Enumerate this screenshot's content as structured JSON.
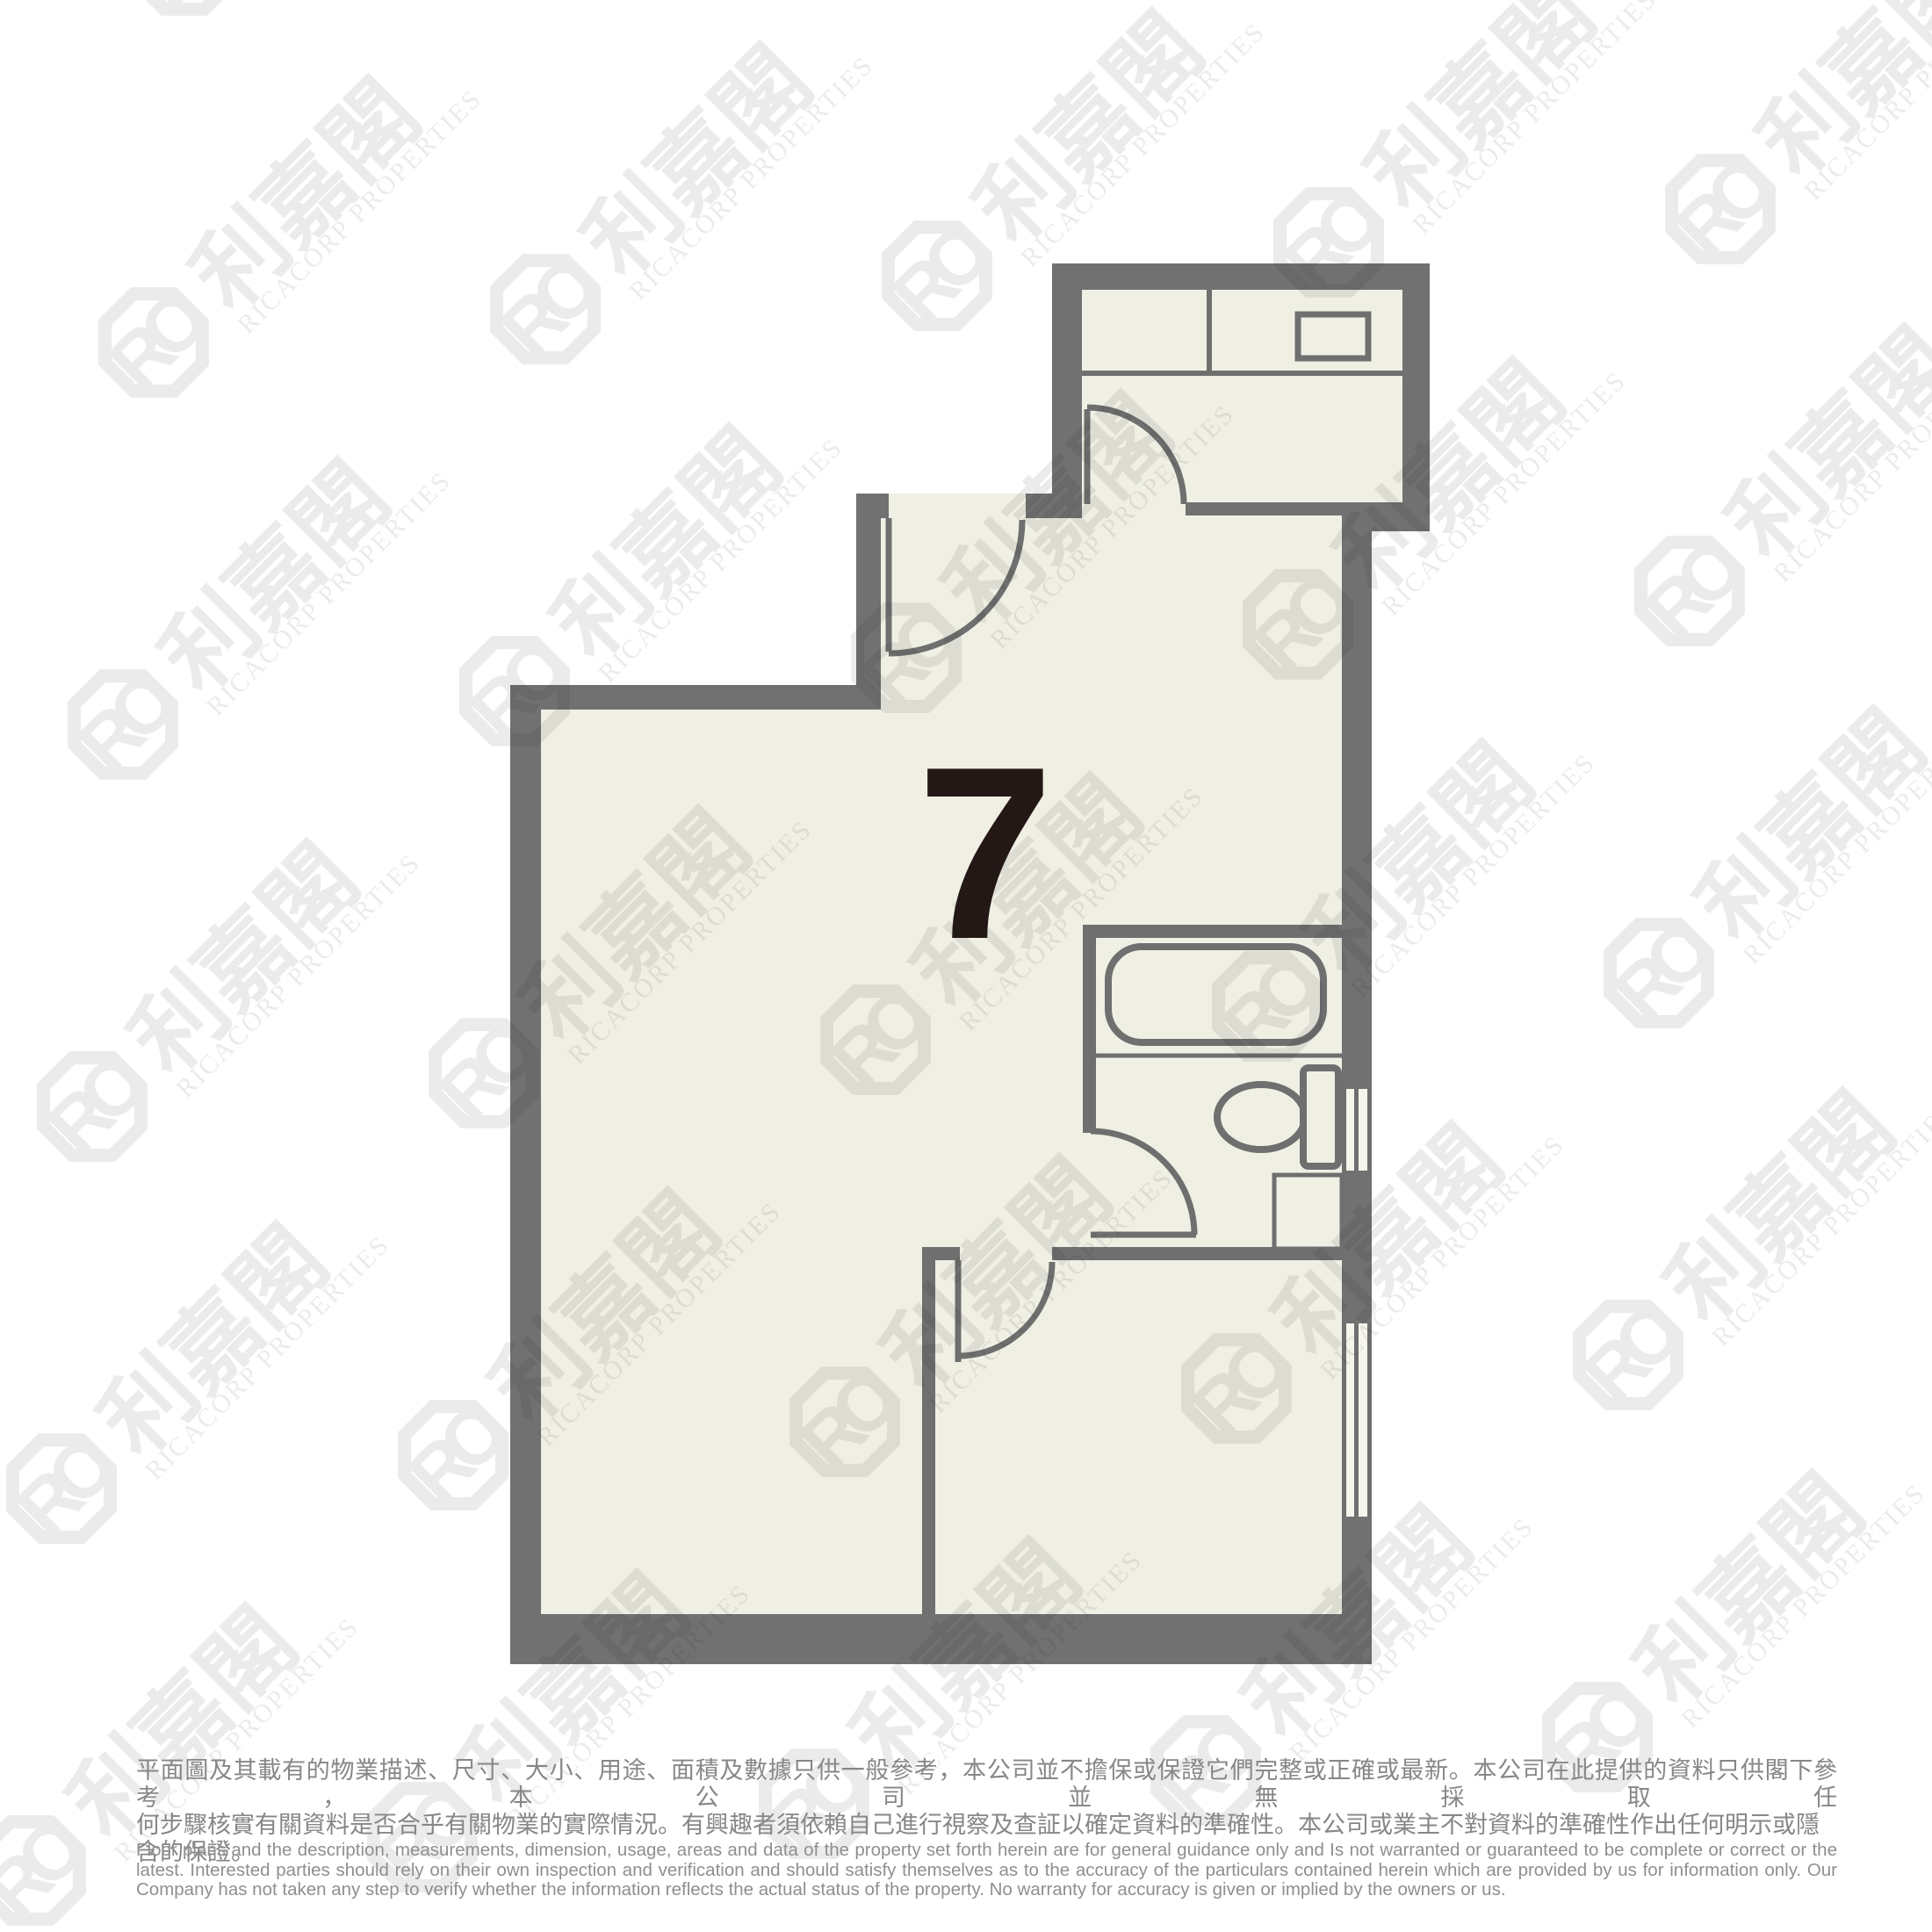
{
  "unit": {
    "number": "7"
  },
  "watermark": {
    "logo_initials": "RC",
    "brand_chinese": "利嘉閣",
    "brand_english": "RICACORP PROPERTIES"
  },
  "floorplan": {
    "colors": {
      "floor": "#f0efe4",
      "wall": "#717171",
      "fixture_line": "#6f6f6f",
      "unit_number": "#231815",
      "watermark": "#1c1c1c",
      "window_fill": "#f6f5ec"
    },
    "fixture_icons": [
      "bathtub-icon",
      "toilet-icon",
      "kitchen-sink-icon",
      "basin-icon",
      "kitchen-counter",
      "door-swing-icon",
      "window-icon"
    ]
  },
  "disclaimer": {
    "chinese_lines": [
      "平面圖及其載有的物業描述、尺寸、大小、用途、面積及數據只供一般參考，本公司並不擔保或保證它們完整或正確或最新。本公司在此提供的資料只供閣下參考，本公司並無採取任",
      "何步驟核實有關資料是否合乎有關物業的實際情況。有興趣者須依賴自己進行視察及查証以確定資料的準確性。本公司或業主不對資料的準確性作出任何明示或隱含的保證。"
    ],
    "english_lines": [
      "Floor plans and the description, measurements, dimension, usage, areas and data of the property set forth herein are for general guidance only and Is not warranted or guaranteed to be complete or correct or the",
      "latest. Interested parties should rely on their own inspection and verification and should satisfy themselves as to the accuracy of the particulars contained herein which are provided by us for information only.  Our",
      "Company has not taken any step to verify whether the information reflects the actual status of the property.  No warranty for accuracy is given or implied by the owners or us."
    ]
  }
}
